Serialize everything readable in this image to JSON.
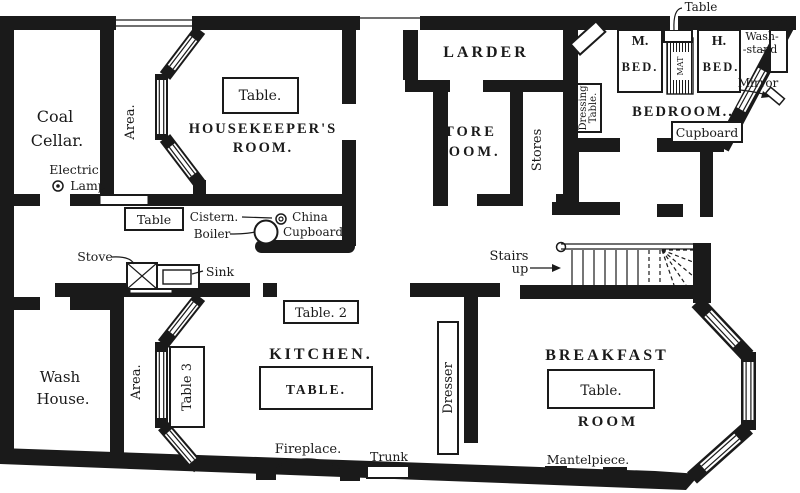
{
  "plan": {
    "type": "floor-plan",
    "ink_color": "#1a1a1a",
    "paper_color": "#ffffff",
    "rooms": {
      "coal_cellar": {
        "lines": [
          "Coal",
          "Cellar."
        ]
      },
      "housekeepers_room": {
        "lines": [
          "HOUSEKEEPER'S",
          "ROOM."
        ]
      },
      "larder": {
        "lines": [
          "LARDER"
        ]
      },
      "store_room": {
        "lines": [
          "STORE",
          "ROOM."
        ]
      },
      "bedroom": {
        "lines": [
          "BEDROOM.."
        ]
      },
      "kitchen": {
        "lines": [
          "KITCHEN."
        ]
      },
      "breakfast_room": {
        "lines": [
          "BREAKFAST",
          "ROOM"
        ]
      },
      "wash_house": {
        "lines": [
          "Wash",
          "House."
        ]
      }
    },
    "labels": {
      "electric_lamp": {
        "lines": [
          "Electric",
          "Lamp"
        ]
      },
      "area_upper": "Area.",
      "area_lower": "Area.",
      "hk_table": "Table.",
      "mid_table": "Table",
      "cistern": "Cistern.",
      "boiler": "Boiler",
      "china_cupboard": {
        "lines": [
          "China",
          "Cupboard"
        ]
      },
      "stove": "Stove",
      "sink": "Sink",
      "stores": "Stores",
      "dressing_table": {
        "lines": [
          "Dressing",
          "Table."
        ]
      },
      "bedroom_table": "Table",
      "m_bed": {
        "lines": [
          "M.",
          "BED."
        ]
      },
      "h_bed": {
        "lines": [
          "H.",
          "BED."
        ]
      },
      "mat": "MAT",
      "wash_stand": {
        "lines": [
          "Wash-",
          "-stand"
        ]
      },
      "mirror": "Mirror",
      "cupboard": "Cupboard",
      "stairs": {
        "lines": [
          "Stairs",
          "up"
        ]
      },
      "table_2": "Table. 2",
      "kitchen_table": "TABLE.",
      "table_3": "Table 3",
      "dresser": "Dresser",
      "fireplace": "Fireplace.",
      "trunk": "Trunk",
      "breakfast_table": "Table.",
      "mantelpiece": "Mantelpiece."
    }
  }
}
